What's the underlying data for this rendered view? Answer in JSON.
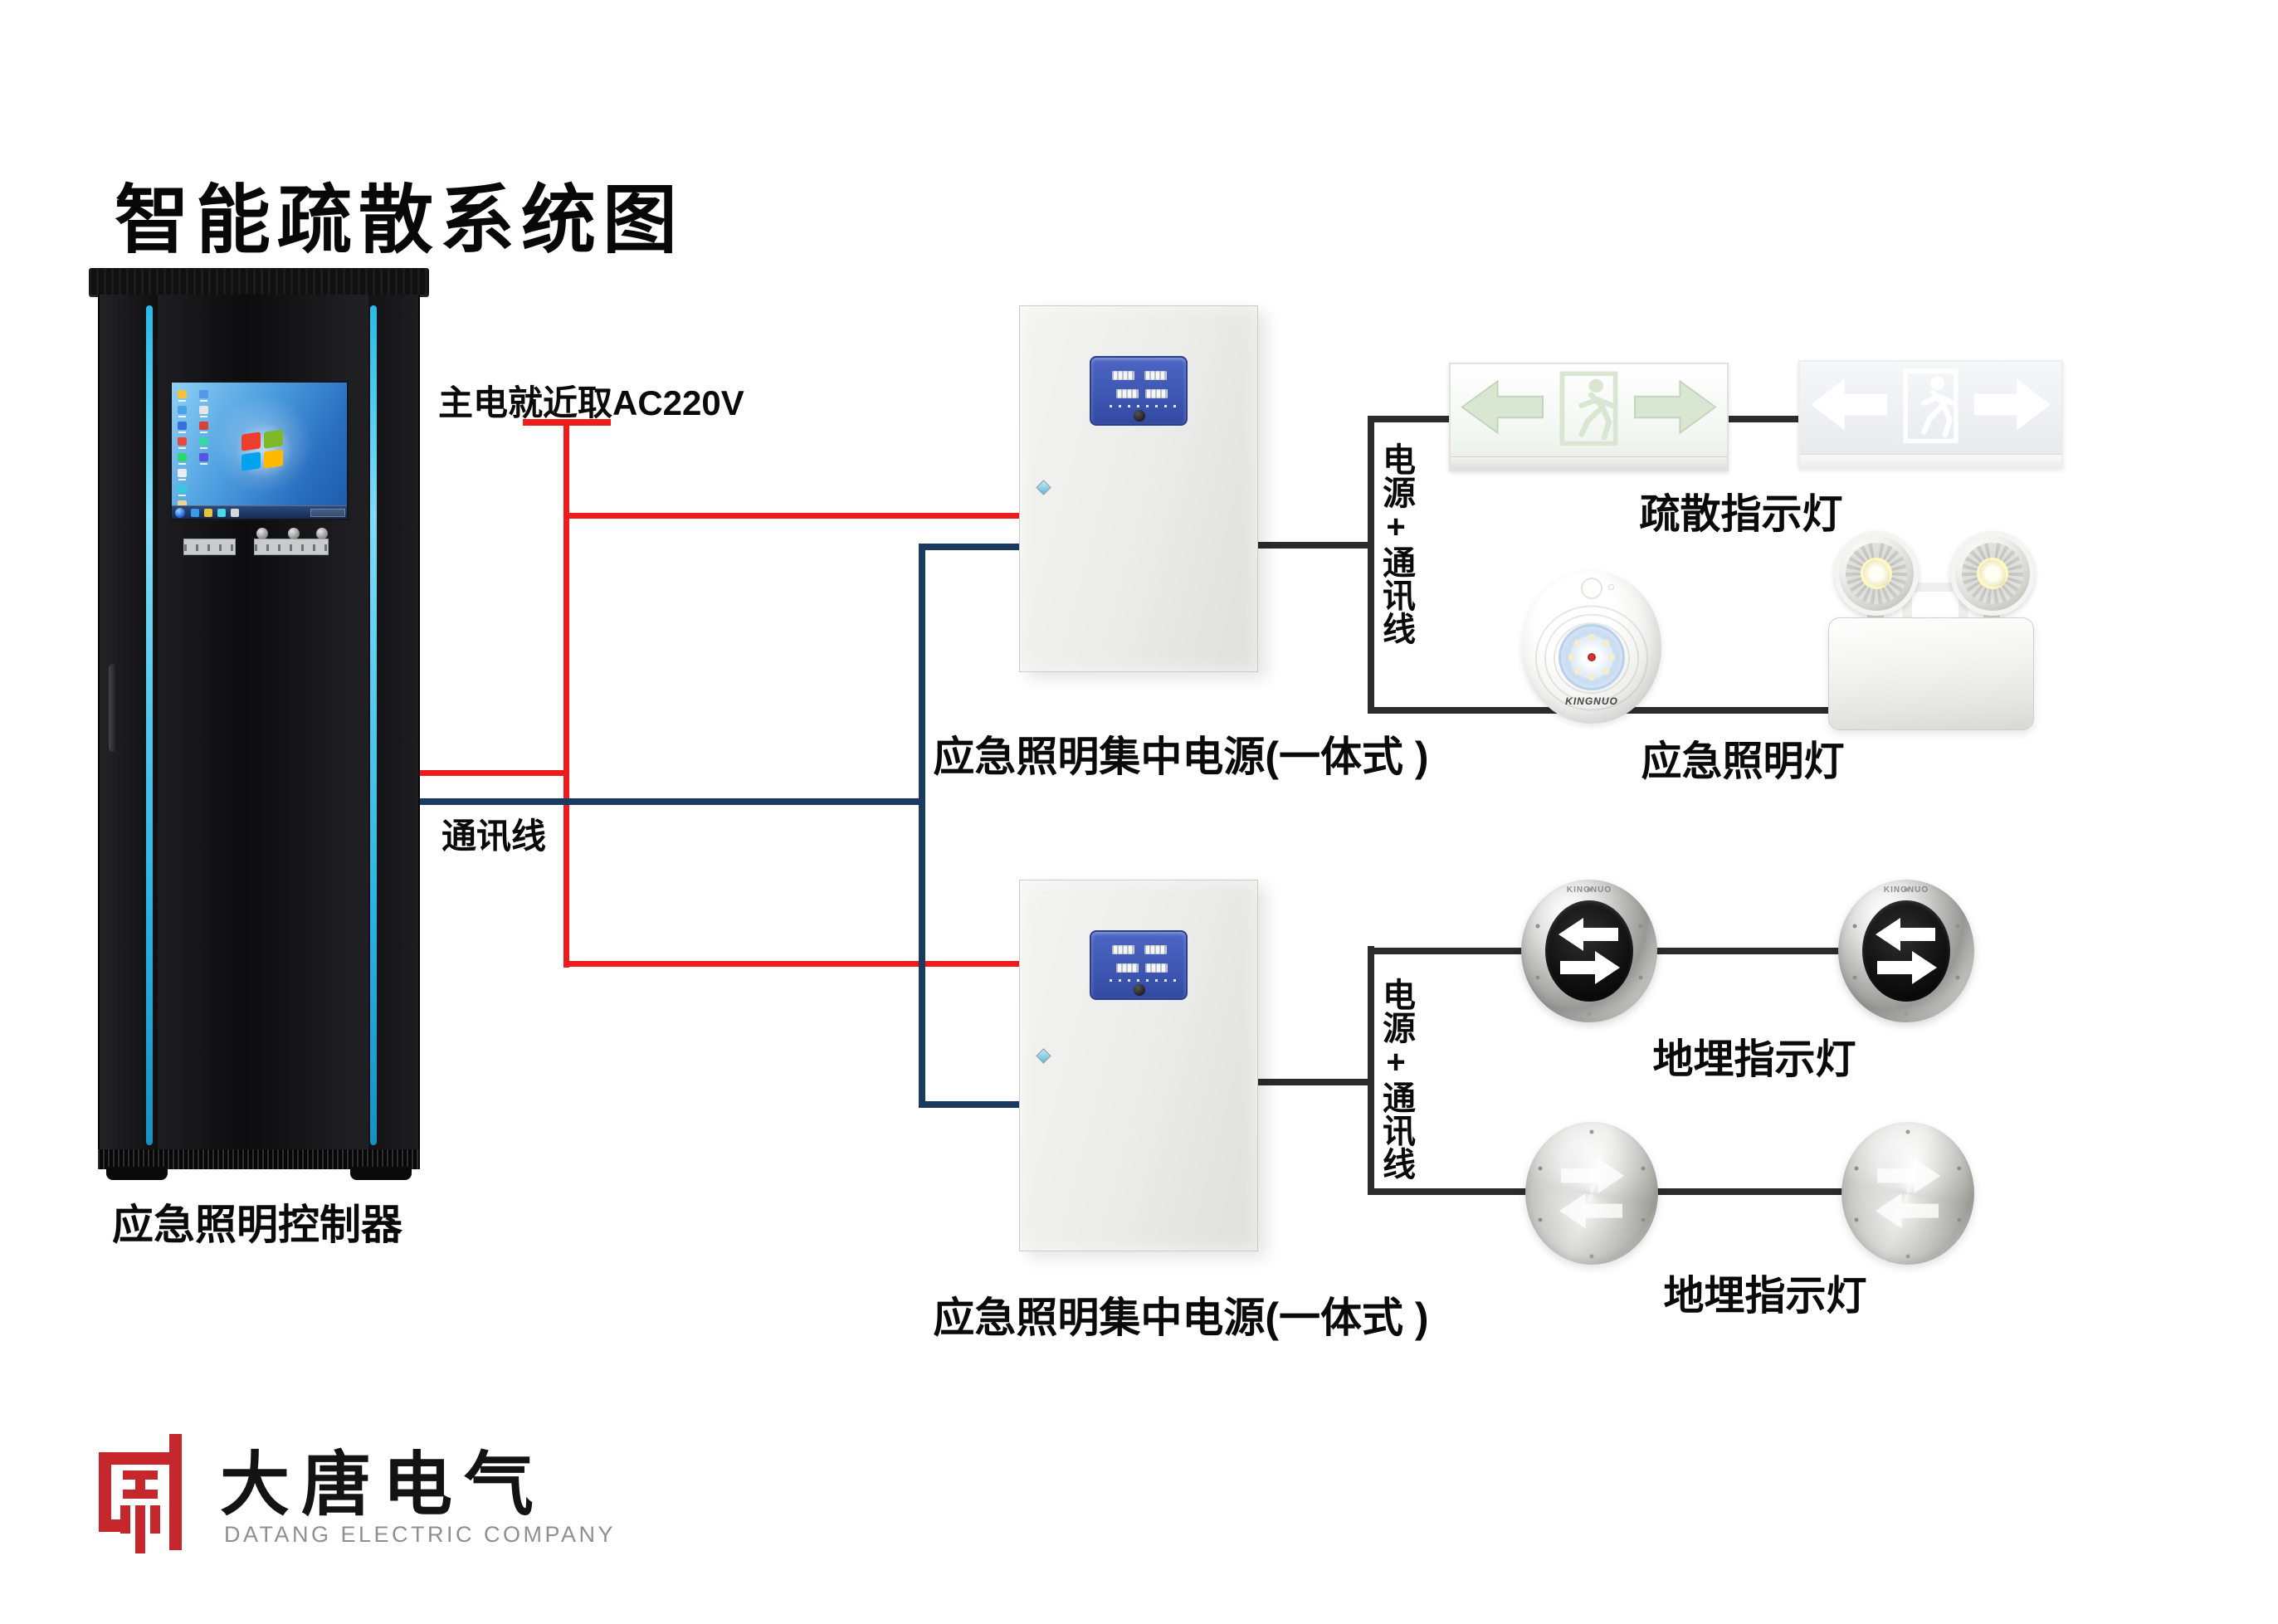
{
  "title": "智能疏散系统图",
  "cabinet": {
    "label": "应急照明控制器"
  },
  "wires": {
    "main_power_label": "主电就近取AC220V",
    "comm_label": "通讯线",
    "power_comm_labels": [
      "电源+通讯线",
      "电源+通讯线"
    ]
  },
  "power_boxes": [
    "应急照明集中电源(一体式 )",
    "应急照明集中电源(一体式 )"
  ],
  "devices": {
    "exit_sign_label": "疏散指示灯",
    "emergency_lamp_label": "应急照明灯",
    "ground_light_labels": [
      "地埋指示灯",
      "地埋指示灯"
    ],
    "lamp_brand": "KINGNUO"
  },
  "logo": {
    "cn": "大唐电气",
    "en": "DATANG ELECTRIC COMPANY"
  },
  "colors": {
    "main_power_wire": "#ee1d1d",
    "comm_wire": "#1b3a5f",
    "power_comm_wire": "#2b2b2b",
    "cabinet_led_strip": "#38c2ec",
    "box_panel_blue": "#3f58b4",
    "logo_red": "#c5272d"
  },
  "screen": {
    "desktop_icon_colors_col1": [
      "#f3c13a",
      "#4aa3e8",
      "#3a6fd8",
      "#e8483a",
      "#2ad86e",
      "#ececec",
      "#38c8e0",
      "#e8d890"
    ],
    "desktop_icon_colors_col2": [
      "#5598e8",
      "#e6e6e6",
      "#d8403a",
      "#34d8a0",
      "#5555e0"
    ],
    "taskbar_icon_colors": [
      "#3a9ae8",
      "#e8c43a",
      "#4ad8e8",
      "#d8d8d8"
    ]
  }
}
